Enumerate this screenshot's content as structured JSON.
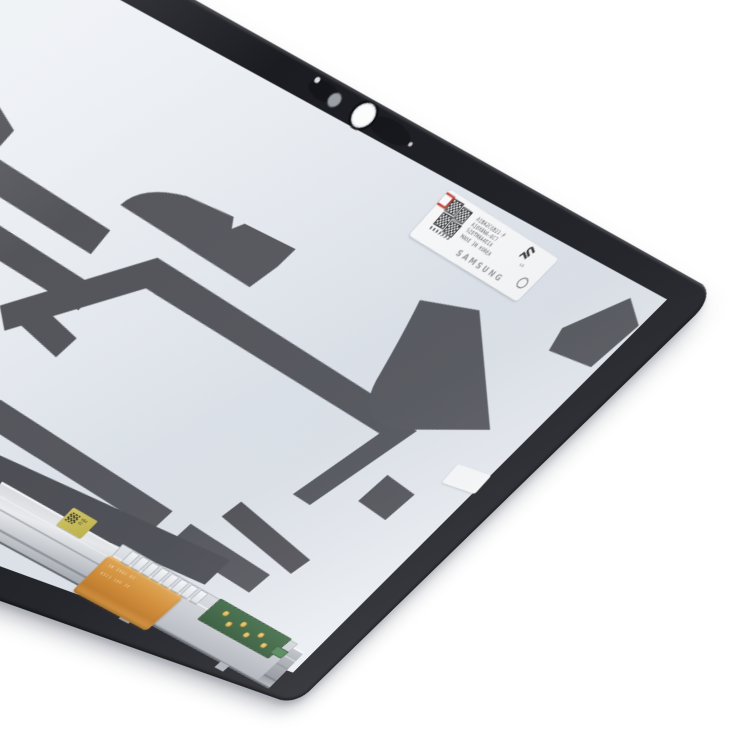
{
  "image": {
    "type": "product-photo",
    "subject": "Tablet LCD screen assembly, rear view, tilted on white background",
    "background_color": "#ffffff"
  },
  "device": {
    "panel_color": "#e9edf2",
    "patch_color": "#54555b",
    "frame_color": "#1b1c21",
    "rail_color": "#c9ccd1",
    "flex_color": "#d88c2e",
    "pcb_color": "#35603a",
    "certification_label": {
      "brand": "SAMSUNG",
      "cert_mark": "UL",
      "cert_suffix": "us",
      "line1": "A1BA2CGB21-F",
      "line2": "A10XBNA-0C7",
      "line3": "S2DTM8A4E1X",
      "line4": "MADE IN KOREA"
    },
    "service_label": {
      "line1": "H94",
      "line2": "02"
    },
    "flex_cable": {
      "line1": "3B 23GC 8Z",
      "line2": "05C3 16D 2E"
    }
  }
}
